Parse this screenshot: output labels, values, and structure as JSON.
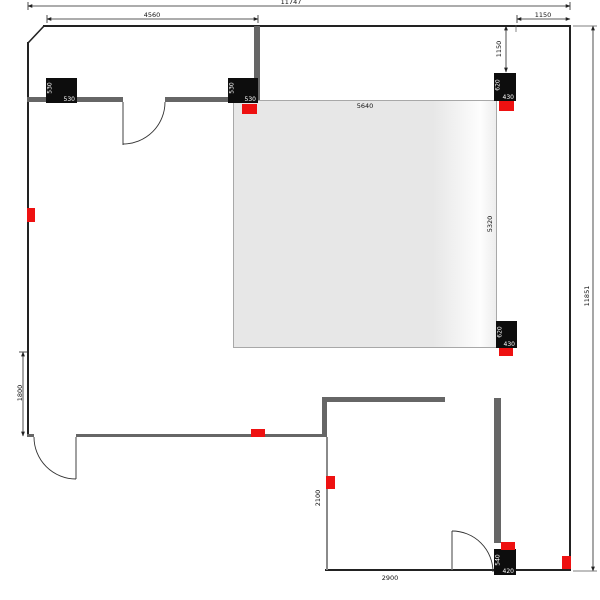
{
  "plan": {
    "title": "floor-plan-drawing",
    "dimensions": {
      "total_width": "11747",
      "section_left": "4560",
      "section_right": "1150",
      "offset_right_vertical": "1150",
      "total_height": "11851",
      "left_height": "1800",
      "room_width": "5640",
      "room_height": "5320",
      "lower_room_height": "2100",
      "lower_room_width": "2900"
    },
    "fixtures": [
      {
        "rotated": "530",
        "label": "530"
      },
      {
        "rotated": "530",
        "label": "530"
      },
      {
        "rotated": "620",
        "label": "430"
      },
      {
        "rotated": "620",
        "label": "430"
      },
      {
        "rotated": "540",
        "label": "420"
      }
    ],
    "colors": {
      "wall_thick": "#666666",
      "wall_thin": "#222222",
      "room_fill": "#e7e7e7",
      "marker_red": "#ee1111",
      "fixture_black": "#0d0d0d"
    }
  }
}
